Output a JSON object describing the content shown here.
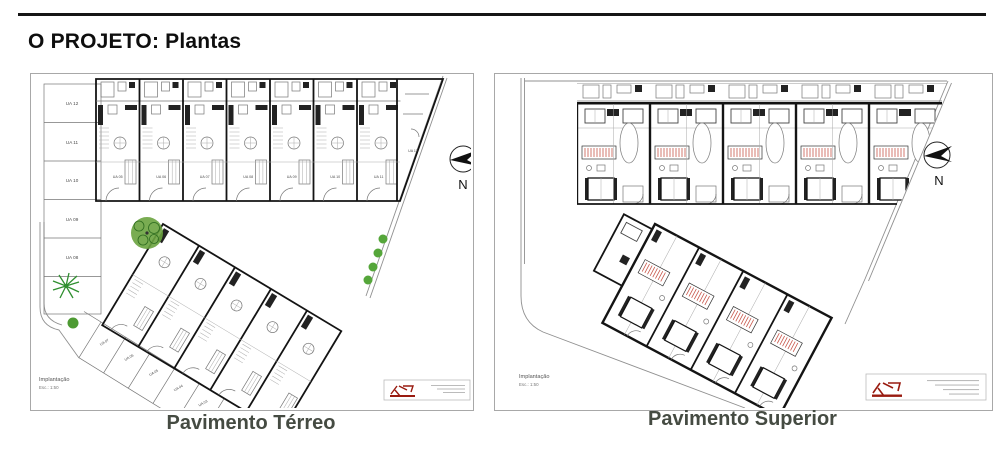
{
  "page": {
    "title": "O PROJETO: Plantas"
  },
  "panels": {
    "left": {
      "caption": "Pavimento Térreo",
      "notes": {
        "line1": "Implantação",
        "line2": "Esc.: 1:50"
      },
      "compass": "N",
      "parking_left": [
        "UA 12",
        "UA 11",
        "UA 10",
        "UA 09",
        "UA 08"
      ],
      "parking_diagonal": [
        "UA 07",
        "UA 06",
        "UA 05",
        "UA 04",
        "UA 03",
        "UA 02"
      ],
      "unit_labels": [
        "UA 05",
        "UA 06",
        "UA 07",
        "UA 08",
        "UA 09",
        "UA 10",
        "UA 11",
        "UA 12"
      ]
    },
    "right": {
      "caption": "Pavimento Superior",
      "notes": {
        "line1": "Implantação",
        "line2": "Esc.: 1:50"
      },
      "compass": "N"
    }
  },
  "icons": {
    "compass": "compass-north-icon",
    "logo": "architect-logo"
  },
  "colors": {
    "rule_black": "#151515",
    "caption_gray_green": "#454b42",
    "wall_black": "#141414",
    "boundary_gray": "#909090",
    "tree_green": "#5da23a",
    "stair_red": "#c8584c",
    "logo_red": "#991b10"
  }
}
